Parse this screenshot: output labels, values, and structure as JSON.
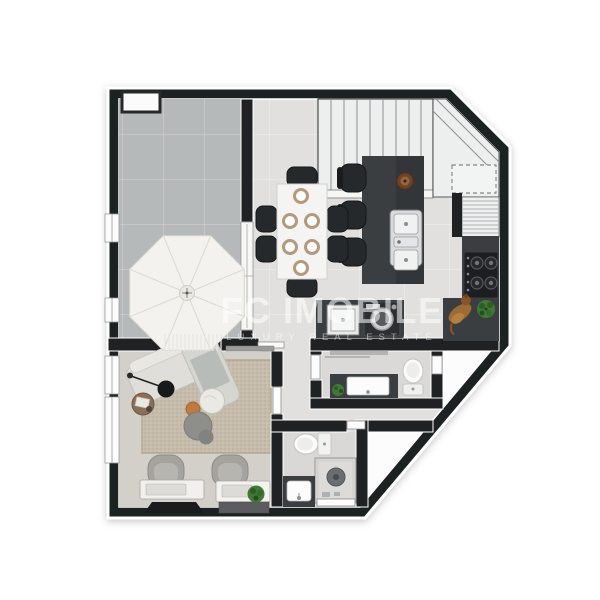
{
  "watermark": {
    "brand": "FC IMOBILE",
    "tagline": "LUXURY REAL ESTATE"
  },
  "palette": {
    "wall": "#1f2123",
    "floor": "#e1e0de",
    "terrace": "#b6b9ba",
    "living": "#d3cfc9",
    "rug": "#c6bcab",
    "counter": "#3b3e40",
    "seat": "#26292b",
    "stairs": "#edeeee",
    "plant": "#3e7a33",
    "wood": "#8a7057",
    "pouf_orange": "#bf7a3e",
    "appliance_dark": "#2c2f31"
  },
  "depicted_elements": [
    "terrace-parasol",
    "dining-table",
    "dining-chairs",
    "kitchen-island",
    "bar-stools",
    "island-double-sink",
    "staircase",
    "corner-landing",
    "cooktop",
    "kitchen-counter",
    "laundry-sink",
    "washing-machine",
    "dog",
    "potted-plants",
    "powder-room-toilet",
    "powder-room-vanity",
    "bathroom-toilet",
    "shower",
    "bathroom-sink",
    "sofa",
    "floor-lamp",
    "coffee-table",
    "side-table",
    "poufs",
    "armchairs",
    "consoles",
    "wall-tv",
    "rug",
    "windows",
    "doors"
  ]
}
